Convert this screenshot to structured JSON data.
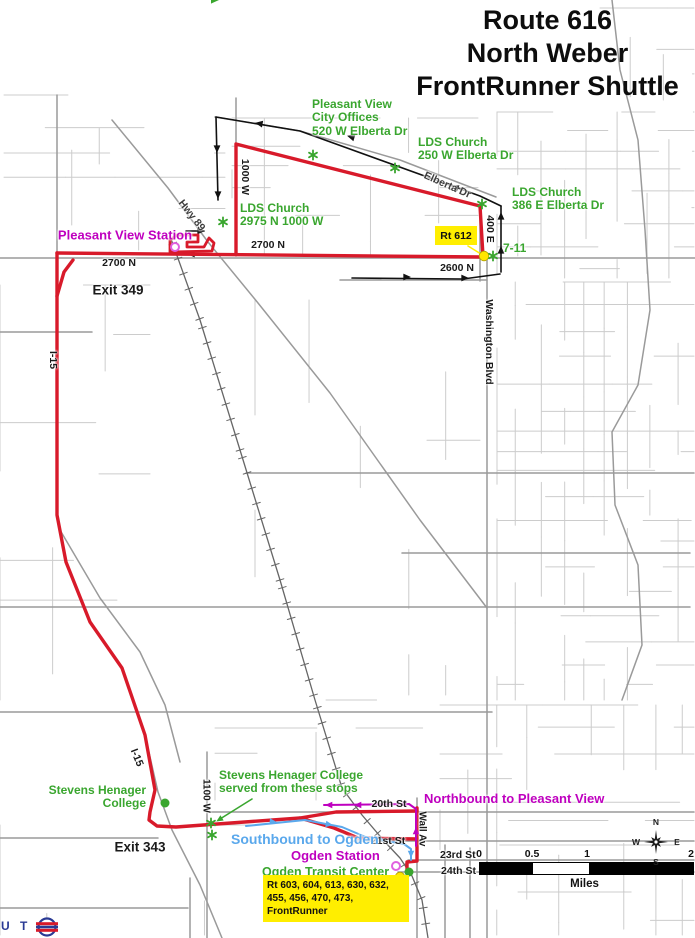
{
  "title": {
    "lines": [
      "Route 616",
      "North Weber",
      "FrontRunner Shuttle"
    ]
  },
  "colors": {
    "route_red": "#d81a2a",
    "green": "#3aa62f",
    "magenta": "#bf00bf",
    "blue": "#5aa8ec",
    "yellow": "#ffee00",
    "black": "#1a1a1a",
    "dark": "#3d3d3d",
    "street_minor": "#cccccc",
    "street_major": "#9a9a9a",
    "rail": "#666666",
    "logo_blue": "#2a3a94"
  },
  "map": {
    "labels": [
      {
        "id": "pleasant-view-station",
        "lines": [
          "Pleasant View Station"
        ],
        "x": 125,
        "y": 236,
        "color": "magenta",
        "size": 13,
        "anchor": "c",
        "rot": 0
      },
      {
        "id": "exit-349",
        "lines": [
          "Exit 349"
        ],
        "x": 118,
        "y": 290,
        "color": "black",
        "size": 13.5,
        "anchor": "c",
        "rot": 0
      },
      {
        "id": "exit-343",
        "lines": [
          "Exit 343"
        ],
        "x": 140,
        "y": 847,
        "color": "black",
        "size": 13.5,
        "anchor": "c",
        "rot": 0
      },
      {
        "id": "n2700-west",
        "lines": [
          "2700 N"
        ],
        "x": 119,
        "y": 264,
        "color": "black",
        "size": 10.5,
        "anchor": "c",
        "rot": 0
      },
      {
        "id": "n2700-east",
        "lines": [
          "2700 N"
        ],
        "x": 268,
        "y": 246,
        "color": "black",
        "size": 10.5,
        "anchor": "c",
        "rot": 0
      },
      {
        "id": "n2600",
        "lines": [
          "2600 N"
        ],
        "x": 457,
        "y": 269,
        "color": "black",
        "size": 10.5,
        "anchor": "c",
        "rot": 0
      },
      {
        "id": "w1000",
        "lines": [
          "1000 W"
        ],
        "x": 244,
        "y": 177,
        "color": "black",
        "size": 10.5,
        "anchor": "c",
        "rot": 90
      },
      {
        "id": "e400",
        "lines": [
          "400 E"
        ],
        "x": 489,
        "y": 229,
        "color": "black",
        "size": 10.5,
        "anchor": "c",
        "rot": 90
      },
      {
        "id": "washington-blvd",
        "lines": [
          "Washington Blvd"
        ],
        "x": 488,
        "y": 342,
        "color": "black",
        "size": 10.5,
        "anchor": "c",
        "rot": 90
      },
      {
        "id": "wall-av",
        "lines": [
          "Wall Av"
        ],
        "x": 422,
        "y": 829,
        "color": "black",
        "size": 10,
        "anchor": "c",
        "rot": 90
      },
      {
        "id": "w1100",
        "lines": [
          "1100 W"
        ],
        "x": 206,
        "y": 796,
        "color": "black",
        "size": 10,
        "anchor": "c",
        "rot": 90
      },
      {
        "id": "hwy-89",
        "lines": [
          "Hwy 89"
        ],
        "x": 191,
        "y": 216,
        "color": "dark",
        "size": 10.5,
        "anchor": "c",
        "rot": 52
      },
      {
        "id": "elberta-dr",
        "lines": [
          "Elberta Dr"
        ],
        "x": 447,
        "y": 186,
        "color": "dark",
        "size": 10.5,
        "anchor": "c",
        "rot": 24
      },
      {
        "id": "i15-north",
        "lines": [
          "I-15"
        ],
        "x": 52,
        "y": 360,
        "color": "black",
        "size": 10.5,
        "anchor": "c",
        "rot": 90
      },
      {
        "id": "i15-south",
        "lines": [
          "I-15"
        ],
        "x": 136,
        "y": 758,
        "color": "black",
        "size": 10.5,
        "anchor": "c",
        "rot": 68
      },
      {
        "id": "st-20th",
        "lines": [
          "20th St"
        ],
        "x": 389,
        "y": 805,
        "color": "black",
        "size": 10.5,
        "anchor": "c",
        "rot": 0
      },
      {
        "id": "st-21st",
        "lines": [
          "21st St"
        ],
        "x": 388,
        "y": 842,
        "color": "black",
        "size": 10.5,
        "anchor": "c",
        "rot": 0
      },
      {
        "id": "st-23rd",
        "lines": [
          "23rd St"
        ],
        "x": 440,
        "y": 856,
        "color": "black",
        "size": 10.5,
        "anchor": "w",
        "rot": 0
      },
      {
        "id": "st-24th",
        "lines": [
          "24th St"
        ],
        "x": 441,
        "y": 872,
        "color": "black",
        "size": 10.5,
        "anchor": "w",
        "rot": 0
      },
      {
        "id": "pv-city-offices",
        "lines": [
          "Pleasant View",
          "City Offices",
          "520 W Elberta Dr"
        ],
        "x": 312,
        "y": 98,
        "color": "green",
        "size": 12,
        "anchor": "tl",
        "rot": 0
      },
      {
        "id": "lds-church-250",
        "lines": [
          "LDS Church",
          "250 W Elberta Dr"
        ],
        "x": 418,
        "y": 136,
        "color": "green",
        "size": 12,
        "anchor": "tl",
        "rot": 0
      },
      {
        "id": "lds-church-386",
        "lines": [
          "LDS Church",
          "386 E Elberta Dr"
        ],
        "x": 512,
        "y": 186,
        "color": "green",
        "size": 12,
        "anchor": "tl",
        "rot": 0
      },
      {
        "id": "lds-church-2975",
        "lines": [
          "LDS Church",
          "2975 N 1000 W"
        ],
        "x": 240,
        "y": 202,
        "color": "green",
        "size": 12,
        "anchor": "tl",
        "rot": 0
      },
      {
        "id": "seven-eleven",
        "lines": [
          "7-11"
        ],
        "x": 503,
        "y": 242,
        "color": "green",
        "size": 12,
        "anchor": "tl",
        "rot": 0
      },
      {
        "id": "stevens-henager-college",
        "lines": [
          "Stevens Henager",
          "College"
        ],
        "x": 146,
        "y": 784,
        "color": "green",
        "size": 12,
        "anchor": "tr",
        "rot": 0
      },
      {
        "id": "shc-served-stops",
        "lines": [
          "Stevens Henager College",
          "served from these stops"
        ],
        "x": 219,
        "y": 769,
        "color": "green",
        "size": 12,
        "anchor": "tl",
        "rot": 0
      },
      {
        "id": "ogden-transit-center",
        "lines": [
          "Ogden Transit Center"
        ],
        "x": 262,
        "y": 865,
        "color": "green",
        "size": 12.5,
        "anchor": "tl",
        "rot": 0
      },
      {
        "id": "northbound-to-pleasant-view",
        "lines": [
          "Northbound to Pleasant View"
        ],
        "x": 424,
        "y": 792,
        "color": "magenta",
        "size": 13,
        "anchor": "tl",
        "rot": 0
      },
      {
        "id": "ogden-station",
        "lines": [
          "Ogden Station"
        ],
        "x": 291,
        "y": 849,
        "color": "magenta",
        "size": 13,
        "anchor": "tl",
        "rot": 0
      },
      {
        "id": "southbound-to-ogden",
        "lines": [
          "Southbound to Ogden"
        ],
        "x": 231,
        "y": 832,
        "color": "blue",
        "size": 14,
        "anchor": "tl",
        "rot": 0
      }
    ],
    "stops_asterisk": [
      {
        "x": 313,
        "y": 155
      },
      {
        "x": 395,
        "y": 168
      },
      {
        "x": 482,
        "y": 204
      },
      {
        "x": 493,
        "y": 256
      },
      {
        "x": 223,
        "y": 222
      },
      {
        "x": 211,
        "y": 823
      },
      {
        "x": 212,
        "y": 835
      }
    ],
    "yellow_dots": [
      {
        "x": 484,
        "y": 256
      },
      {
        "x": 400,
        "y": 877
      }
    ],
    "green_dots": [
      {
        "x": 165,
        "y": 803
      },
      {
        "x": 409,
        "y": 872
      }
    ],
    "station_circles": [
      {
        "x": 175,
        "y": 247
      },
      {
        "x": 396,
        "y": 866
      }
    ]
  },
  "callouts": {
    "rt612": "Rt 612",
    "transit_lines": [
      "Rt 603, 604, 613, 630, 632,",
      "455, 456, 470, 473,",
      "FrontRunner"
    ]
  },
  "scalebar": {
    "ticks": [
      "0",
      "0.5",
      "1",
      "2"
    ],
    "unit": "Miles"
  },
  "compass": {
    "n": "N",
    "e": "E",
    "s": "S",
    "w": "W"
  },
  "logo": {
    "text": "U T A"
  }
}
